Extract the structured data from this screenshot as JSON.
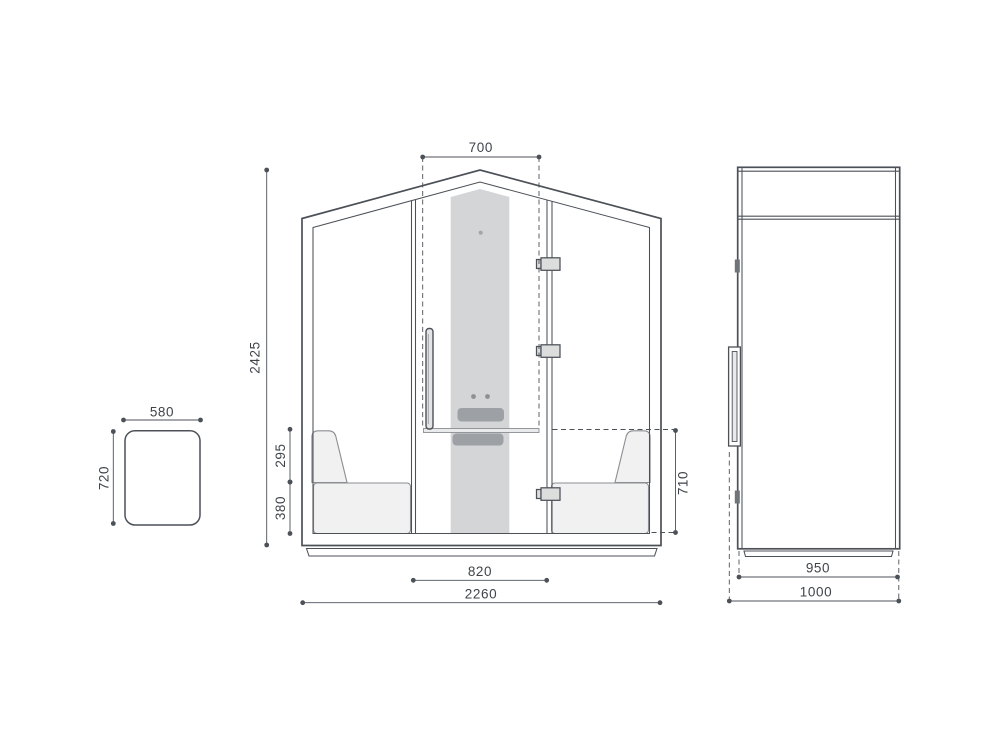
{
  "drawing": {
    "title": "Meeting pod technical drawing",
    "front_view": {
      "dims": {
        "door_opening_width": "700",
        "overall_height": "2425",
        "backrest_height": "295",
        "seat_height": "380",
        "table_span": "820",
        "overall_width": "2260",
        "tabletop_height": "710"
      }
    },
    "side_view": {
      "dims": {
        "body_depth": "950",
        "overall_depth": "1000"
      }
    },
    "tabletop_view": {
      "dims": {
        "width": "580",
        "depth": "720"
      }
    },
    "colors": {
      "line": "#4c5158",
      "line_light": "#8b8e93",
      "panel_fill": "#d3d5d7",
      "accent_fill": "#9da0a4",
      "seat_fill": "#f1f1f2",
      "hinge_fill": "#dcdddd",
      "background": "#ffffff"
    }
  }
}
